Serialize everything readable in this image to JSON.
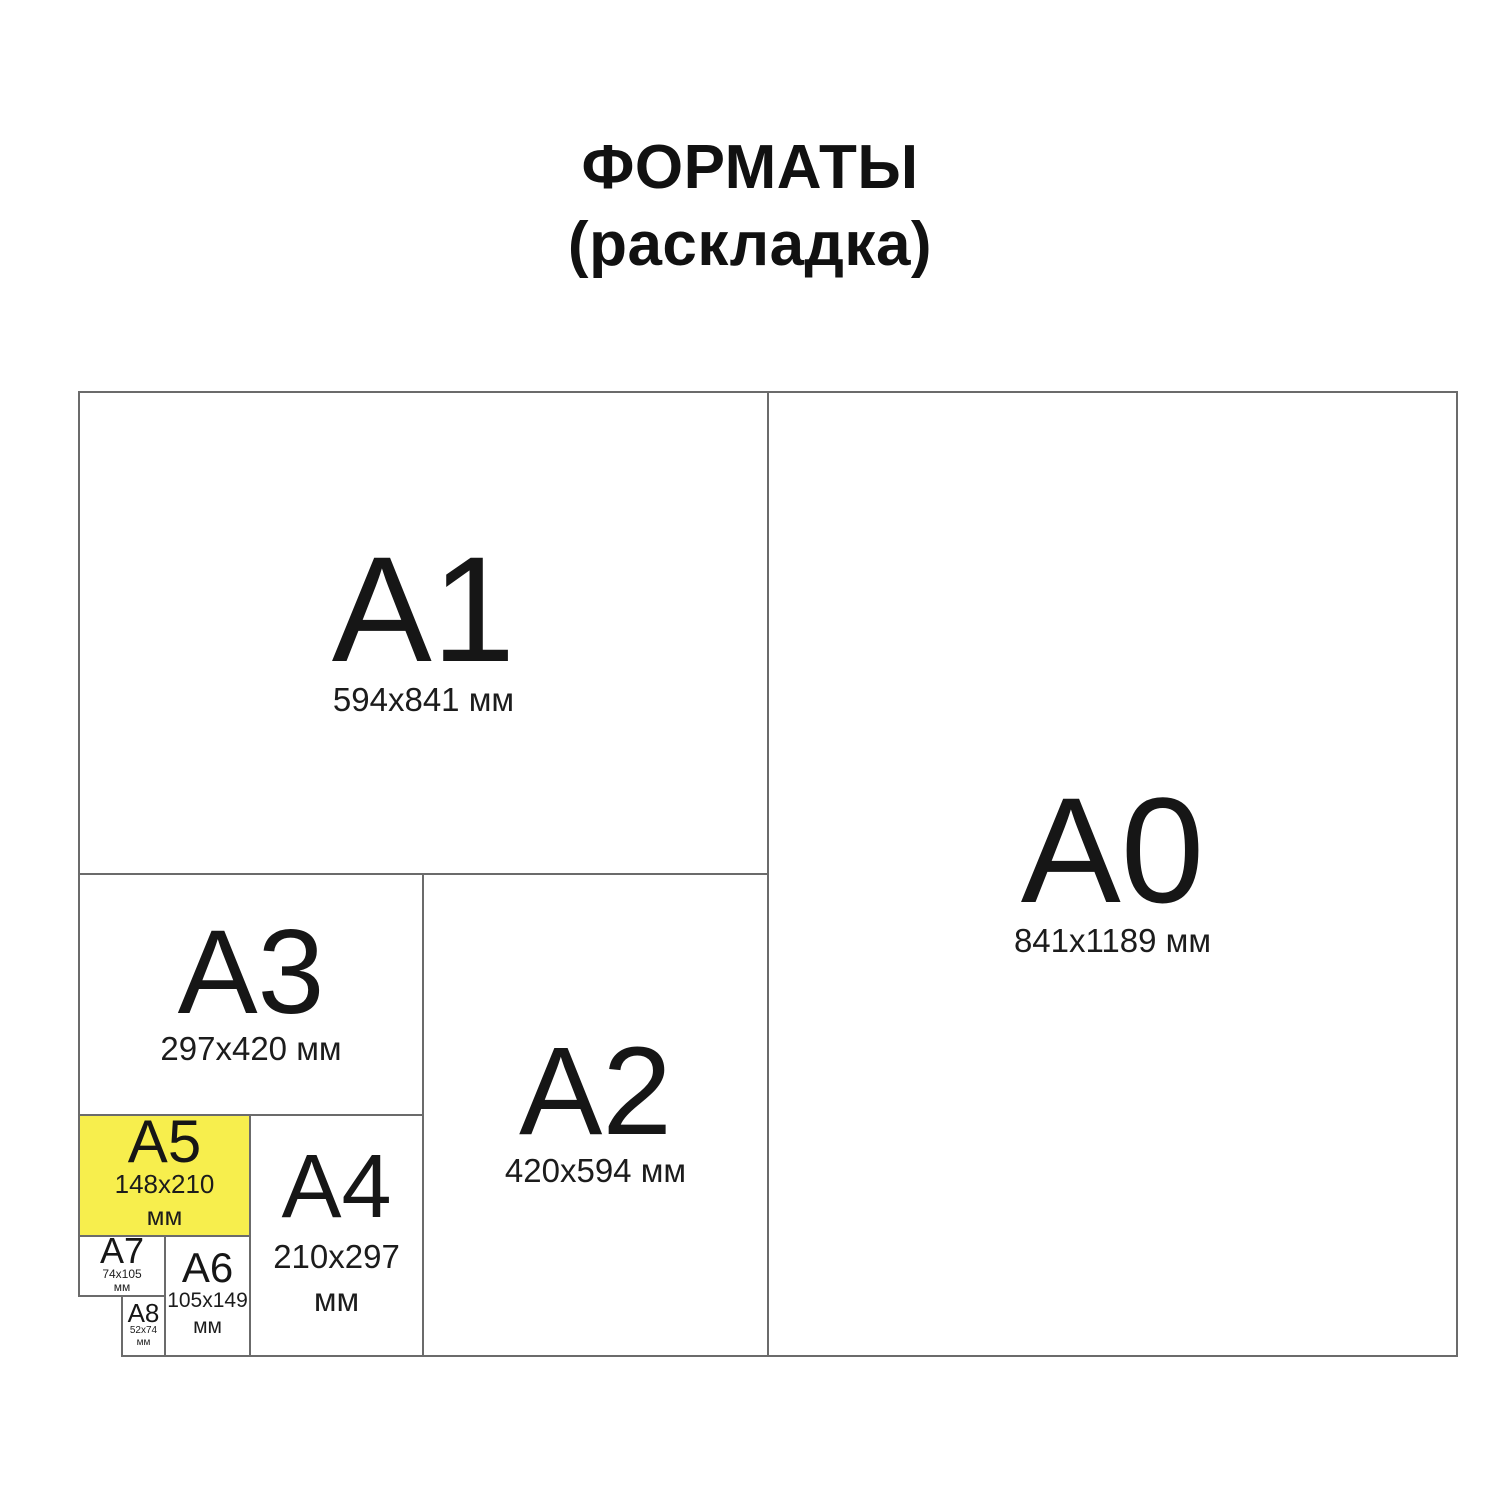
{
  "title": {
    "line1": "ФОРМАТЫ",
    "line2": "(раскладка)"
  },
  "colors": {
    "background": "#ffffff",
    "line": "#6b6b6b",
    "text": "#161616",
    "highlight": "#f7ee4d"
  },
  "formats": [
    {
      "id": "A1",
      "label": "А1",
      "size_line1": "594x841 мм"
    },
    {
      "id": "A0",
      "label": "А0",
      "size_line1": "841x1189 мм"
    },
    {
      "id": "A3",
      "label": "А3",
      "size_line1": "297x420 мм"
    },
    {
      "id": "A2",
      "label": "А2",
      "size_line1": "420x594 мм"
    },
    {
      "id": "A5",
      "label": "А5",
      "size_line1": "148x210",
      "size_line2": "мм",
      "highlighted": true
    },
    {
      "id": "A4",
      "label": "А4",
      "size_line1": "210x297",
      "size_line2": "мм"
    },
    {
      "id": "A7",
      "label": "А7",
      "size_line1": "74x105",
      "size_line2": "мм"
    },
    {
      "id": "A6",
      "label": "А6",
      "size_line1": "105x149",
      "size_line2": "мм"
    },
    {
      "id": "A8",
      "label": "А8",
      "size_line1": "52x74",
      "size_line2": "мм"
    }
  ]
}
